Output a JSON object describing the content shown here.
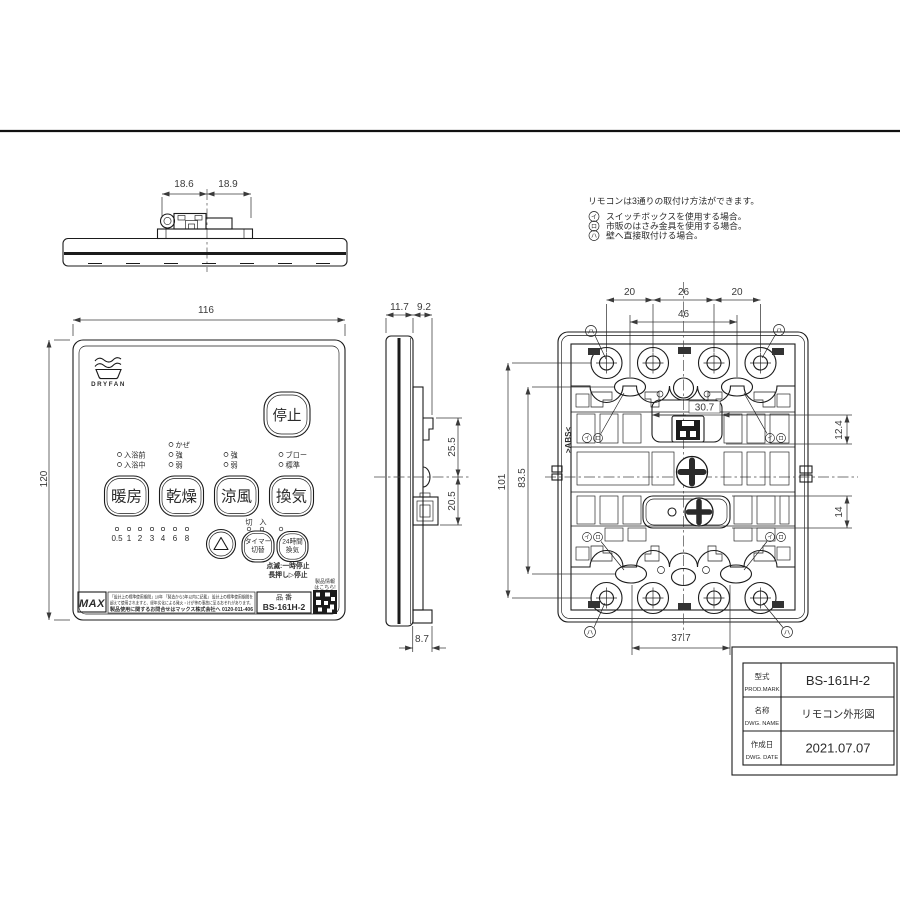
{
  "colors": {
    "line": "#1b1b1b",
    "dim": "#3a3a3a",
    "bg": "#ffffff"
  },
  "notes": {
    "intro": "リモコンは3通りの取付け方法ができます。",
    "items": [
      {
        "mark": "イ",
        "text": "スイッチボックスを使用する場合。"
      },
      {
        "mark": "ロ",
        "text": "市販のはさみ金具を使用する場合。"
      },
      {
        "mark": "ハ",
        "text": "壁へ直接取付ける場合。"
      }
    ]
  },
  "top_view": {
    "dim_left": "18.6",
    "dim_right": "18.9"
  },
  "front_view": {
    "dim_width": "116",
    "dim_height": "120",
    "brand": "DRYFAN",
    "stop_button": "停止",
    "leds": {
      "col1": [
        "入浴前",
        "入浴中"
      ],
      "col2": [
        "かぜ",
        "強",
        "弱"
      ],
      "col3": [
        "強",
        "弱"
      ],
      "col4": [
        "ブロー",
        "標準"
      ]
    },
    "mode_buttons": [
      "暖房",
      "乾燥",
      "涼風",
      "換気"
    ],
    "timer_scale": [
      "0.5",
      "1",
      "2",
      "3",
      "4",
      "6",
      "8"
    ],
    "switch_off": "切",
    "switch_on": "入",
    "timer_button_line1": "タイマー",
    "timer_button_line2": "切替",
    "vent24_line1": "24時間",
    "vent24_line2": "換気",
    "hint_line1": "点滅:一時停止",
    "hint_line2": "長押し▷停止",
    "maker_logo": "MAX",
    "warning_line1": "「設計上の標準使用期間」10年 「製造から3年以内に記載」 設計上の標準使用期間を",
    "warning_line2": "超えて使用されますと、経年劣化による発火・けが等の事故に至るおそれがあります。",
    "warning_line3": "製品使用に関するお問合せはマックス株式会社へ 0120-011-406",
    "qr_caption_line1": "製品情報",
    "qr_caption_line2": "はこちら!",
    "part_label": "品 番",
    "part_number": "BS-161H-2"
  },
  "side_view": {
    "dim_depth_front": "11.7",
    "dim_depth_back": "9.2",
    "dim_upper": "25.5",
    "dim_lower": "20.5",
    "dim_bottom": "8.7"
  },
  "back_view": {
    "material": ">ABS<",
    "dim_top_left": "20",
    "dim_top_mid": "26",
    "dim_top_right": "20",
    "dim_span": "46",
    "dim_connector": "30.7",
    "dim_right_upper": "12.4",
    "dim_right_lower": "14",
    "dim_left_outer": "101",
    "dim_left_inner": "83.5",
    "dim_bottom": "37.7",
    "marks": {
      "i": "イ",
      "ro": "ロ",
      "ha": "ハ"
    }
  },
  "title_block": {
    "rows": [
      {
        "label_jp": "型式",
        "label_en": "PROD.MARK",
        "value": "BS-161H-2"
      },
      {
        "label_jp": "名称",
        "label_en": "DWG. NAME",
        "value": "リモコン外形図"
      },
      {
        "label_jp": "作成日",
        "label_en": "DWG. DATE",
        "value": "2021.07.07"
      }
    ]
  }
}
